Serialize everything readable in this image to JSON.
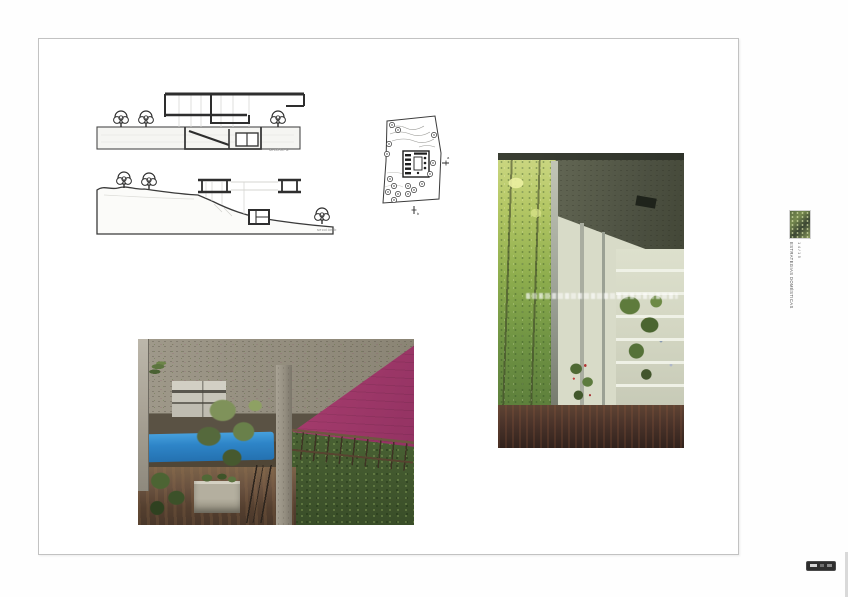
{
  "document": {
    "captions": {
      "section_a": "sección a",
      "section_b": "sección b"
    },
    "site_plan": {
      "marker_right": "a",
      "marker_bottom": "b"
    },
    "margin": {
      "series_title": "ESTRATEGIAS DOMÉSTICAS",
      "edition": "14/15"
    },
    "colors": {
      "page_border": "#c2c2c2",
      "magenta_wall": "#a53c6d",
      "blue_band": "#2e85c8",
      "foliage_green": "#8fae4e",
      "concrete_gray": "#958f80",
      "floor_dark": "#3a2a22",
      "widget_bg": "#2e2e2e"
    }
  }
}
